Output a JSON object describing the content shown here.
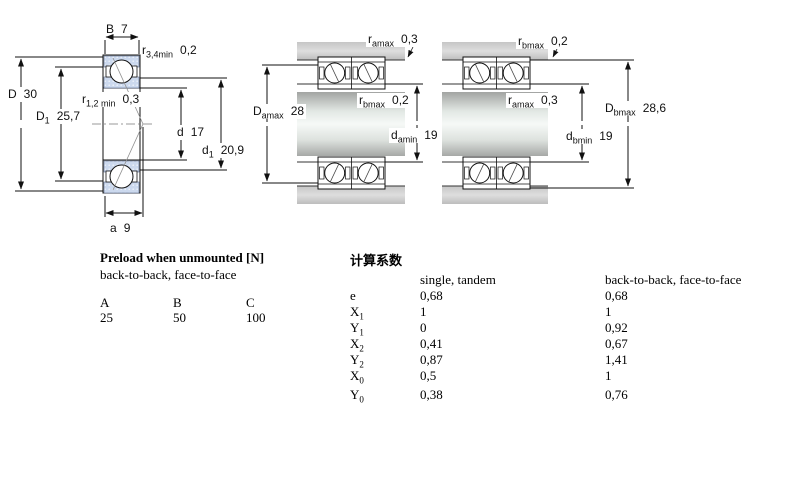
{
  "diagrams": {
    "left": {
      "labels": {
        "B": {
          "main": "B",
          "sub": "",
          "value": "7"
        },
        "r34": {
          "main": "r",
          "sub": "3,4min",
          "value": "0,2"
        },
        "D": {
          "main": "D",
          "sub": "",
          "value": "30"
        },
        "D1": {
          "main": "D",
          "sub": "1",
          "value": "25,7"
        },
        "r12": {
          "main": "r",
          "sub": "1,2 min",
          "value": "0,3"
        },
        "d": {
          "main": "d",
          "sub": "",
          "value": "17"
        },
        "d1": {
          "main": "d",
          "sub": "1",
          "value": "20,9"
        },
        "a": {
          "main": "a",
          "sub": "",
          "value": "9"
        }
      }
    },
    "middle": {
      "labels": {
        "ramax": {
          "main": "r",
          "sub": "amax",
          "value": "0,3"
        },
        "Damax": {
          "main": "D",
          "sub": "amax",
          "value": "28"
        },
        "rbmax": {
          "main": "r",
          "sub": "bmax",
          "value": "0,2"
        },
        "damin": {
          "main": "d",
          "sub": "amin",
          "value": "19"
        }
      }
    },
    "right": {
      "labels": {
        "rbmax": {
          "main": "r",
          "sub": "bmax",
          "value": "0,2"
        },
        "ramax": {
          "main": "r",
          "sub": "amax",
          "value": "0,3"
        },
        "Dbmax": {
          "main": "D",
          "sub": "bmax",
          "value": "28,6"
        },
        "dbmin": {
          "main": "d",
          "sub": "bmin",
          "value": "19"
        }
      }
    }
  },
  "preload": {
    "title": "Preload when unmounted [N]",
    "subtitle": "back-to-back, face-to-face",
    "columns": [
      "A",
      "B",
      "C"
    ],
    "values": [
      "25",
      "50",
      "100"
    ]
  },
  "factors": {
    "title": "计算系数",
    "col1_header": "single, tandem",
    "col2_header": "back-to-back, face-to-face",
    "rows": [
      {
        "sym": "e",
        "sub": "",
        "v1": "0,68",
        "v2": "0,68"
      },
      {
        "sym": "X",
        "sub": "1",
        "v1": "1",
        "v2": "1"
      },
      {
        "sym": "Y",
        "sub": "1",
        "v1": "0",
        "v2": "0,92"
      },
      {
        "sym": "X",
        "sub": "2",
        "v1": "0,41",
        "v2": "0,67"
      },
      {
        "sym": "Y",
        "sub": "2",
        "v1": "0,87",
        "v2": "1,41"
      },
      {
        "sym": "X",
        "sub": "0",
        "v1": "0,5",
        "v2": "1"
      },
      {
        "sym": "Y",
        "sub": "0",
        "v1": "0,38",
        "v2": "0,76"
      }
    ]
  },
  "colors": {
    "ring_blue": "#ccd9ee",
    "band_gray": "#c9c9c9",
    "line": "#111111"
  }
}
